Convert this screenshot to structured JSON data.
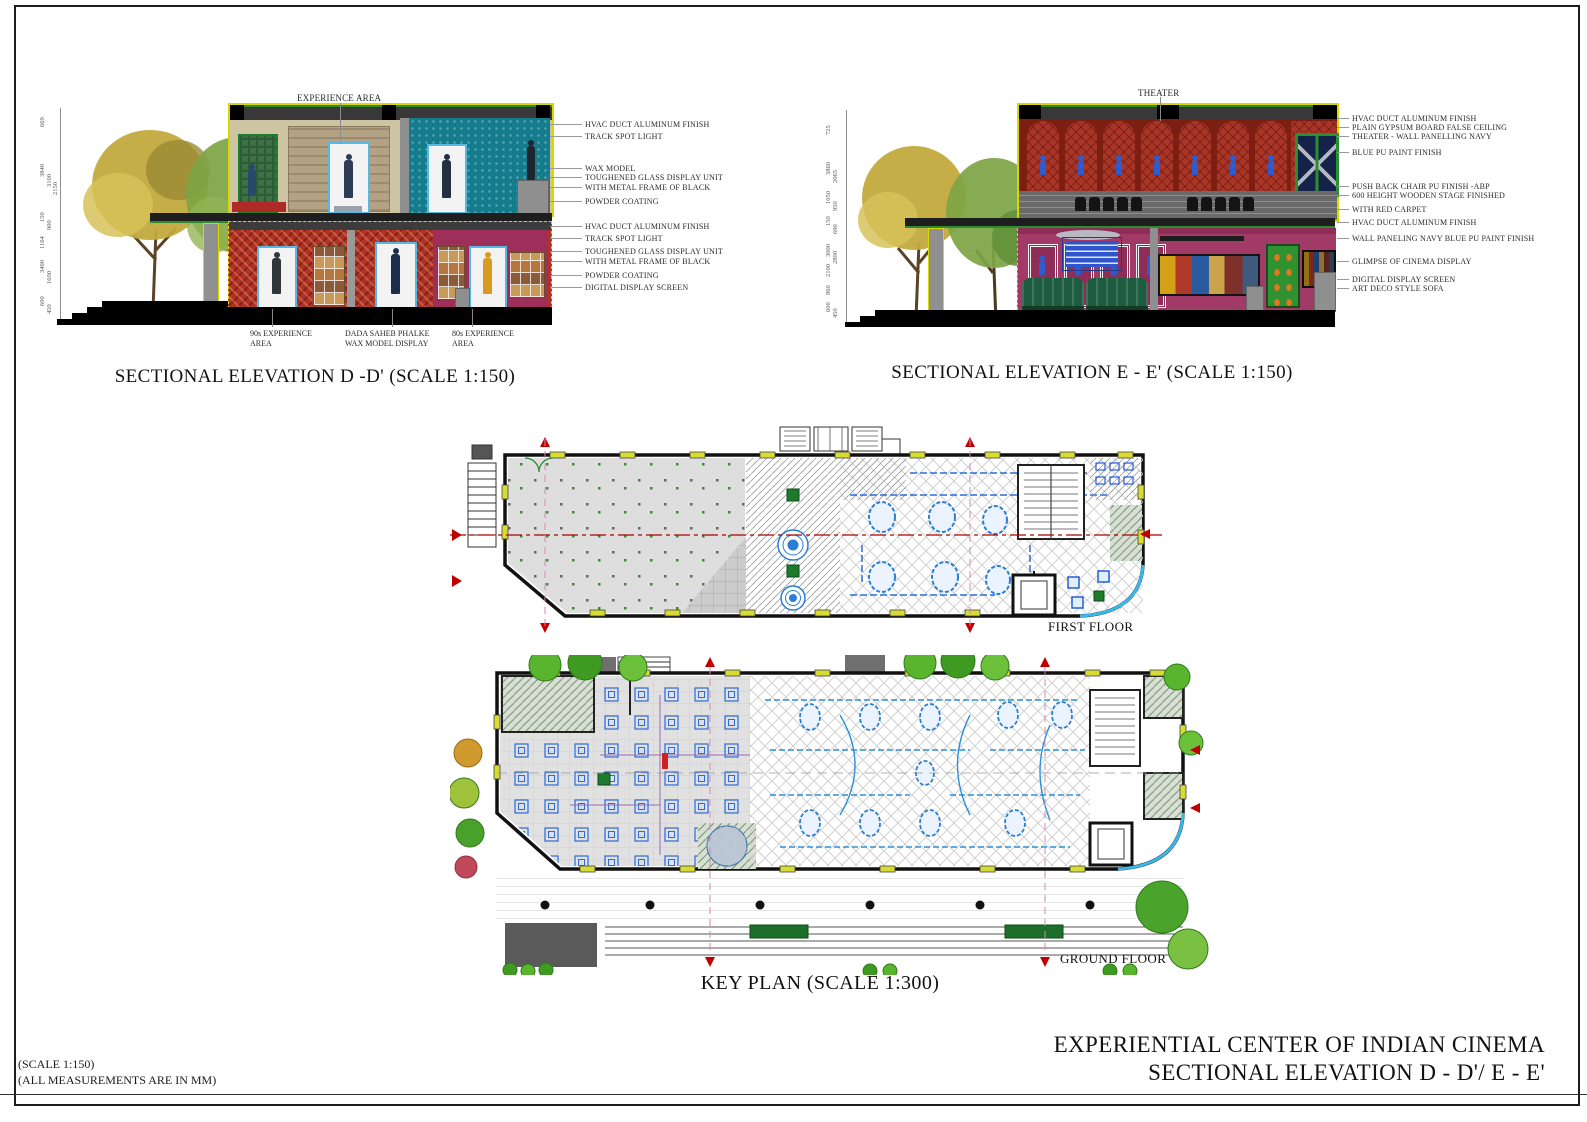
{
  "sheet": {
    "notes": {
      "scale_note": "(SCALE 1:150)",
      "measure_note": "(ALL MEASUREMENTS ARE IN MM)"
    },
    "titleblock": {
      "project_title": "EXPERIENTIAL CENTER OF INDIAN CINEMA",
      "sheet_title": "SECTIONAL ELEVATION D - D'/ E - E'"
    }
  },
  "elevation_d": {
    "title": "SECTIONAL ELEVATION D -D' (SCALE 1:150)",
    "top_label": "EXPERIENCE AREA",
    "bottom_labels": [
      "90s EXPERIENCE AREA",
      "DADA SAHEB PHALKE WAX MODEL DISPLAY",
      "80s EXPERIENCE AREA"
    ],
    "annotations": [
      "HVAC DUCT ALUMINUM FINISH",
      "TRACK SPOT LIGHT",
      "WAX MODEL",
      "TOUGHENED GLASS DISPLAY UNIT",
      "WITH METAL FRAME OF BLACK",
      "POWDER COATING",
      "HVAC DUCT ALUMINUM FINISH",
      "TRACK SPOT LIGHT",
      "TOUGHENED GLASS DISPLAY UNIT",
      "WITH METAL FRAME OF BLACK",
      "POWDER COATING",
      "DIGITAL DISPLAY SCREEN"
    ],
    "dimensions": [
      "669",
      "3840",
      "3100",
      "2150",
      "150",
      "900",
      "1164",
      "3490",
      "1600",
      "600",
      "450"
    ]
  },
  "elevation_e": {
    "title": "SECTIONAL ELEVATION E - E' (SCALE 1:150)",
    "top_label": "THEATER",
    "annotations": [
      "HVAC DUCT ALUMINUM FINISH",
      "PLAIN GYPSUM BOARD FALSE CEILING",
      "THEATER - WALL PANELLING NAVY",
      "BLUE PU PAINT FINISH",
      "PUSH BACK CHAIR  PU FINISH -ABP",
      "600 HEIGHT WOODEN STAGE FINISHED",
      "WITH RED CARPET",
      "HVAC DUCT ALUMINUM FINISH",
      "WALL PANELING NAVY BLUE PU PAINT FINISH",
      "GLIMPSE OF CINEMA DISPLAY",
      "DIGITAL DISPLAY SCREEN",
      "ART DECO STYLE SOFA"
    ],
    "dimensions": [
      "725",
      "3860",
      "2065",
      "1050",
      "950",
      "150",
      "690",
      "3000",
      "2800",
      "2100",
      "860",
      "600",
      "450"
    ]
  },
  "plans": {
    "first_floor_label": "FIRST FLOOR",
    "ground_floor_label": "GROUND FLOOR",
    "key_plan_title": "KEY PLAN (SCALE 1:300)"
  },
  "colors": {
    "column_highlight": "#d8d800",
    "red_wall": "#b03226",
    "magenta_wall": "#9e2f5a",
    "teal_wall": "#157c8e",
    "theater_red": "#7c1f12",
    "display_blue": "#2a7fd4",
    "glass_cyan": "#3ab7e8",
    "marquee_blue": "#2f55cc",
    "sofa_green": "#1e5c40",
    "section_line_red": "#aa0000",
    "tree_green": "#4aa32a"
  }
}
